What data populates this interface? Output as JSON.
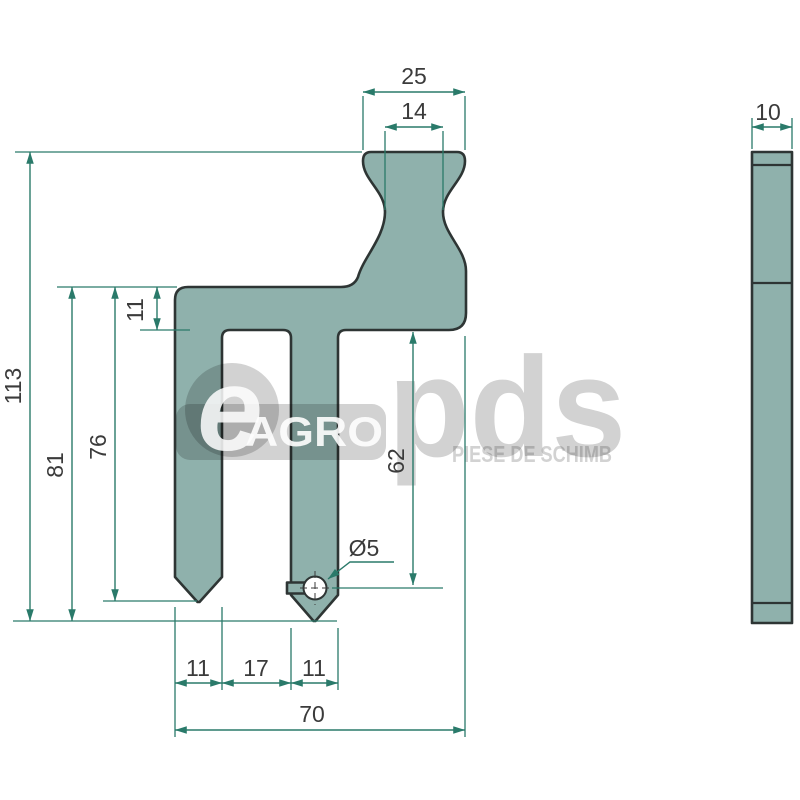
{
  "watermark": {
    "e_letter": "e",
    "brand": "AGRO",
    "logo": "pds",
    "tagline": "PIESE DE SCHIMB"
  },
  "front_view": {
    "dimensions": {
      "head_width_outer": "25",
      "head_width_inner": "14",
      "total_height": "113",
      "height_to_mid_tip": "81",
      "height_to_left_tip": "76",
      "arm_thickness": "11",
      "arm_to_hole_center": "62",
      "hole_diameter": "Ø5",
      "left_tine_width": "11",
      "tine_gap": "17",
      "mid_tine_width": "11",
      "total_width": "70"
    }
  },
  "side_view": {
    "thickness": "10"
  },
  "colors": {
    "part_fill": "#8fb1ac",
    "outline": "#2e3534",
    "dimension_line": "#2a7a6a",
    "dimension_text": "#3b3b3b",
    "watermark_gray": "#d2d2d2"
  }
}
